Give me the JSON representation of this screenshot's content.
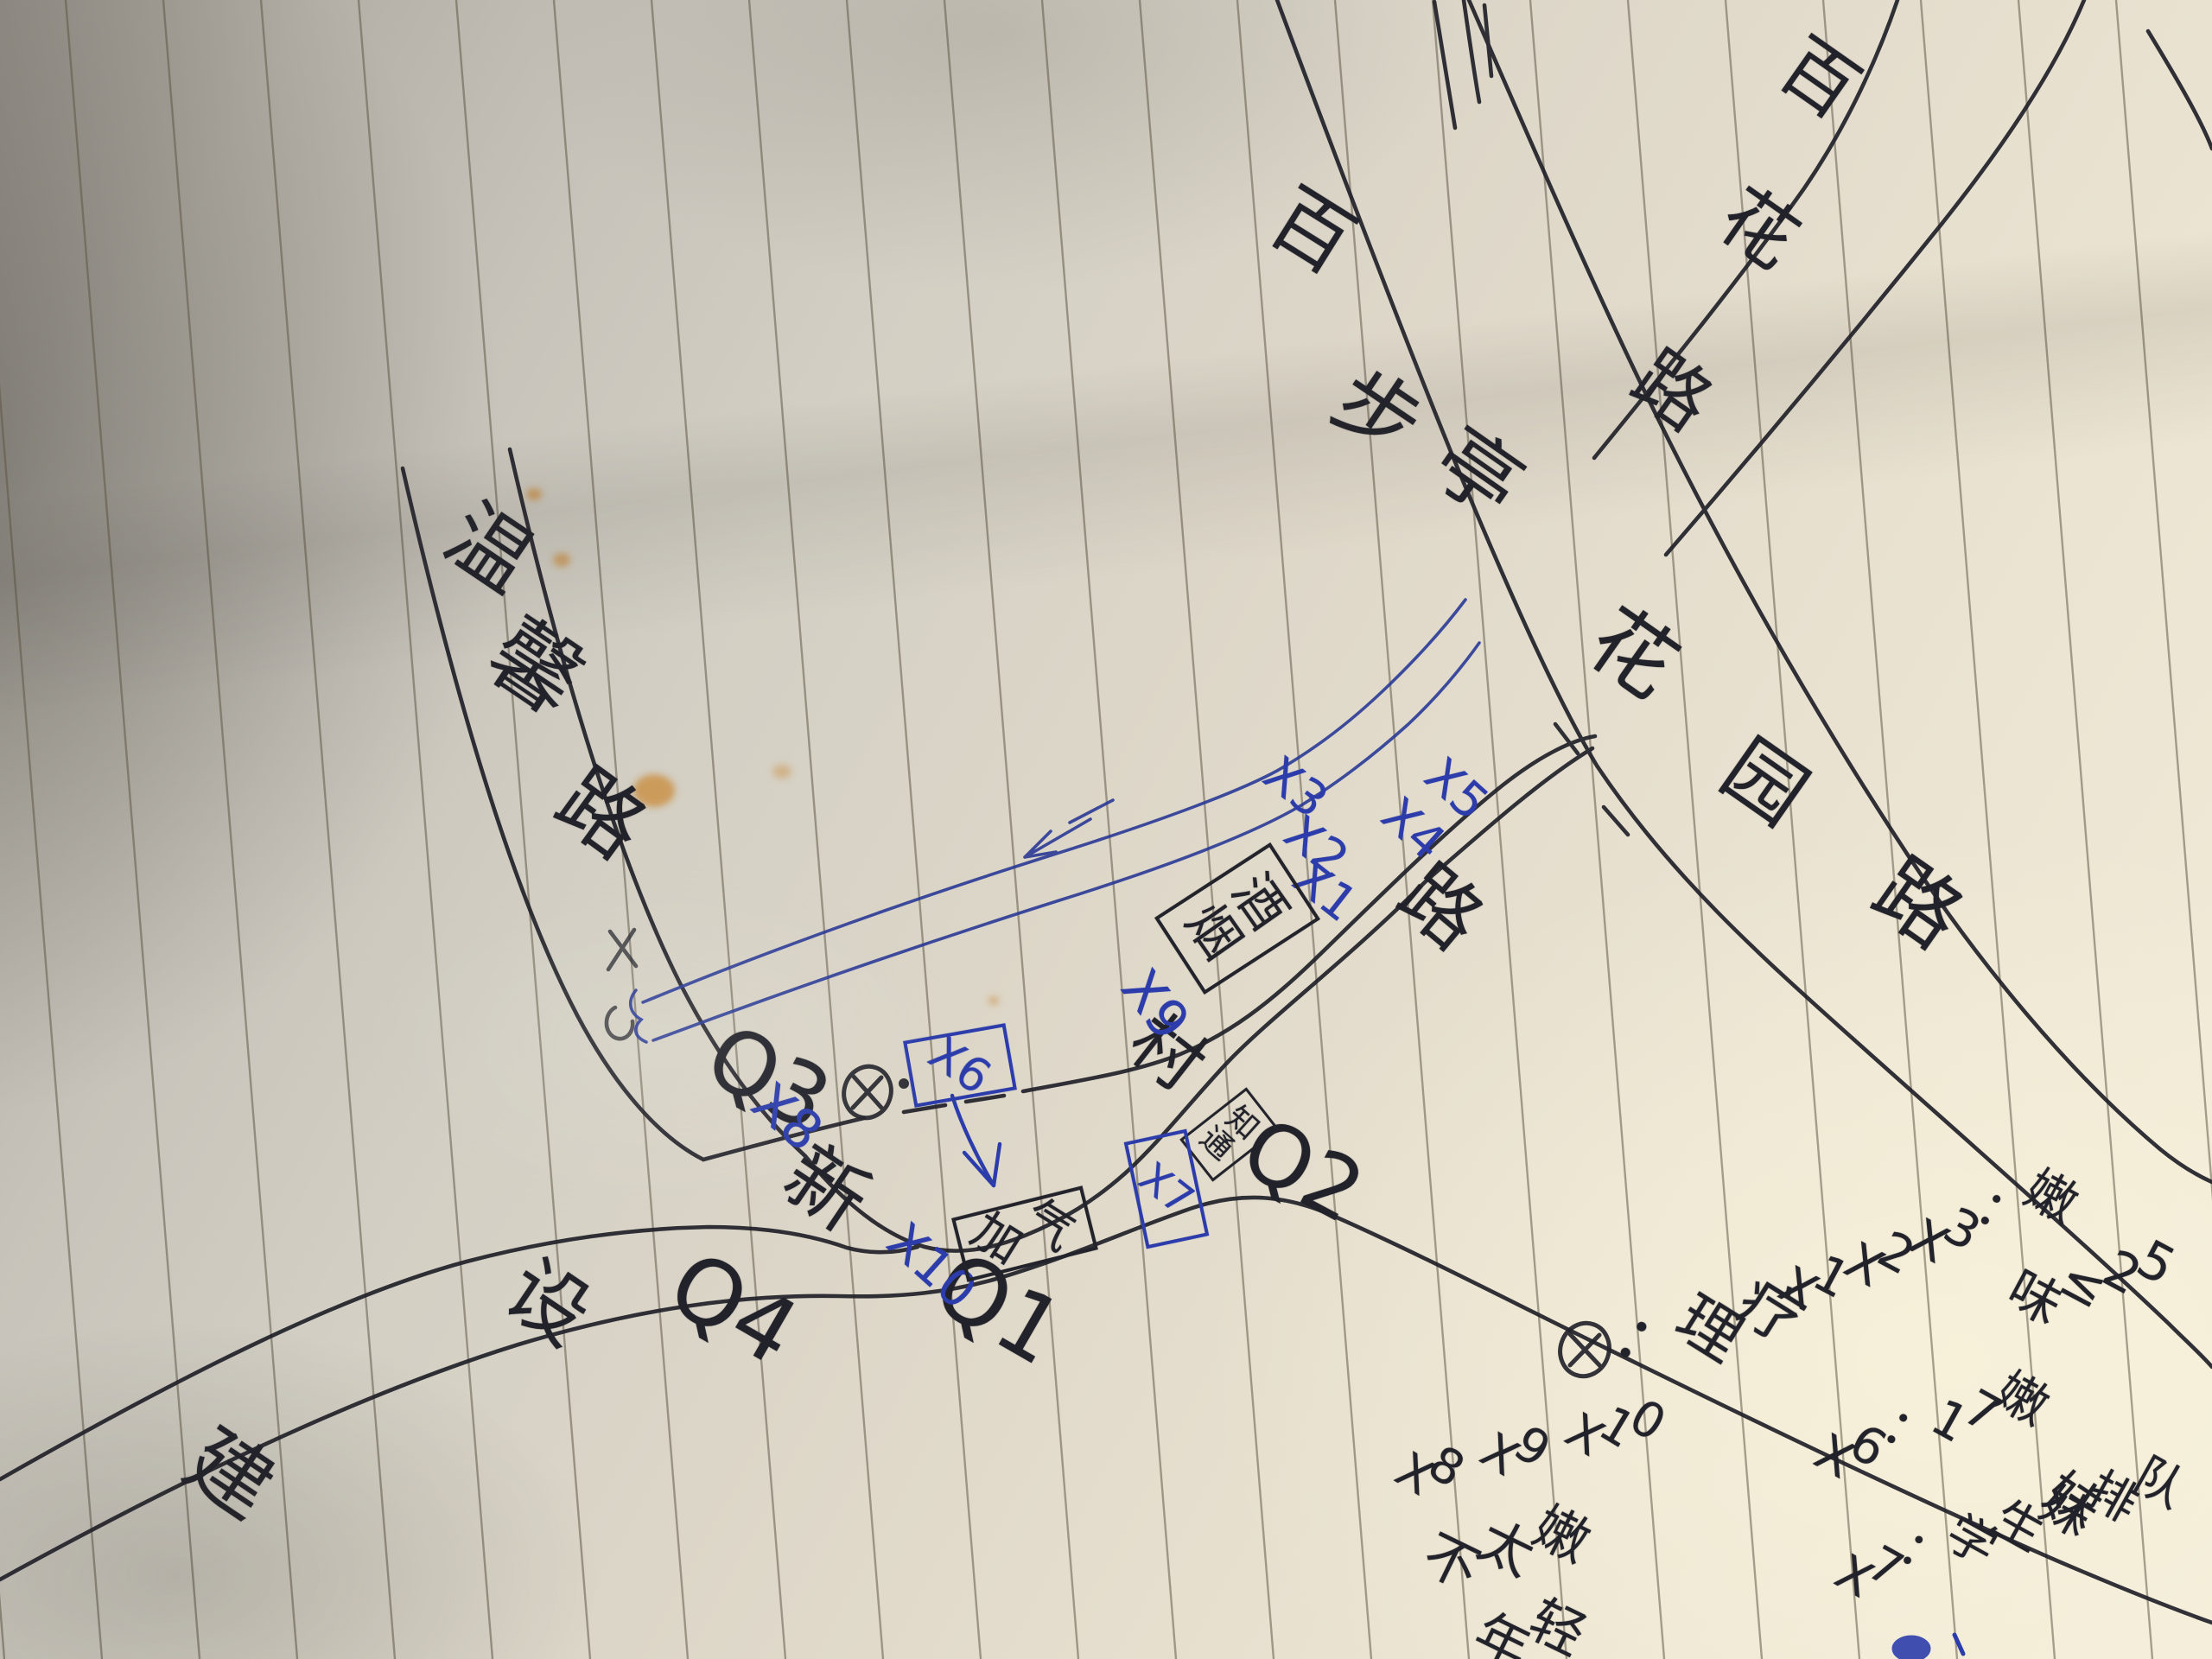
{
  "map_type": "hand-drawn street map sketch on ruled paper",
  "ink_colors": {
    "pen": "#22222b",
    "ballpoint_blue": "#2c3dab",
    "river_blue": "#2b3a96",
    "stain_orange": "#c8842f"
  },
  "roads": {
    "wenxin": {
      "label": "温馨路",
      "chars": [
        "温",
        "馨",
        "路"
      ]
    },
    "xincun": {
      "label": "新村路",
      "chars": [
        "新",
        "村",
        "路"
      ]
    },
    "jianshe": {
      "label": "建设路",
      "chars": [
        "建",
        "设"
      ]
    },
    "baibuting": {
      "label": "百步亭花园路",
      "chars": [
        "百",
        "步",
        "亭",
        "花",
        "园",
        "路"
      ]
    },
    "baihua": {
      "label": "百花路",
      "chars": [
        "百",
        "花",
        "路"
      ]
    }
  },
  "markers": {
    "q1": "Q1",
    "q2": "Q2",
    "q3": "Q3",
    "q4": "Q4",
    "x1": "X1",
    "x2": "X2",
    "x3": "X3",
    "x4": "X4",
    "x5": "X5",
    "x8": "X8",
    "x9": "X9",
    "x10": "X10"
  },
  "boxes": {
    "yanjiu": {
      "label": "烟酒",
      "chars": [
        "烟",
        "酒"
      ]
    },
    "jiaqi": {
      "label": "加气",
      "chars": [
        "加",
        "气"
      ]
    },
    "tongzhi": {
      "label": "通知",
      "chars": [
        "通",
        "知"
      ]
    },
    "x6": {
      "label": "X6"
    },
    "x7": {
      "label": "X7"
    }
  },
  "legend": {
    "liliao": {
      "symbol": "circle-x",
      "text": "：理疗"
    },
    "x123": {
      "line1": "X1X2X3：嫩",
      "line2": "味≤25"
    },
    "x6": {
      "line1": "X6：17嫩",
      "line2": "妹"
    },
    "x7": {
      "line1": "X7：学生妹排队"
    },
    "x8910": {
      "line1": "X8 X9 X10",
      "line2": "不太嫩",
      "line3": "年轻"
    }
  }
}
